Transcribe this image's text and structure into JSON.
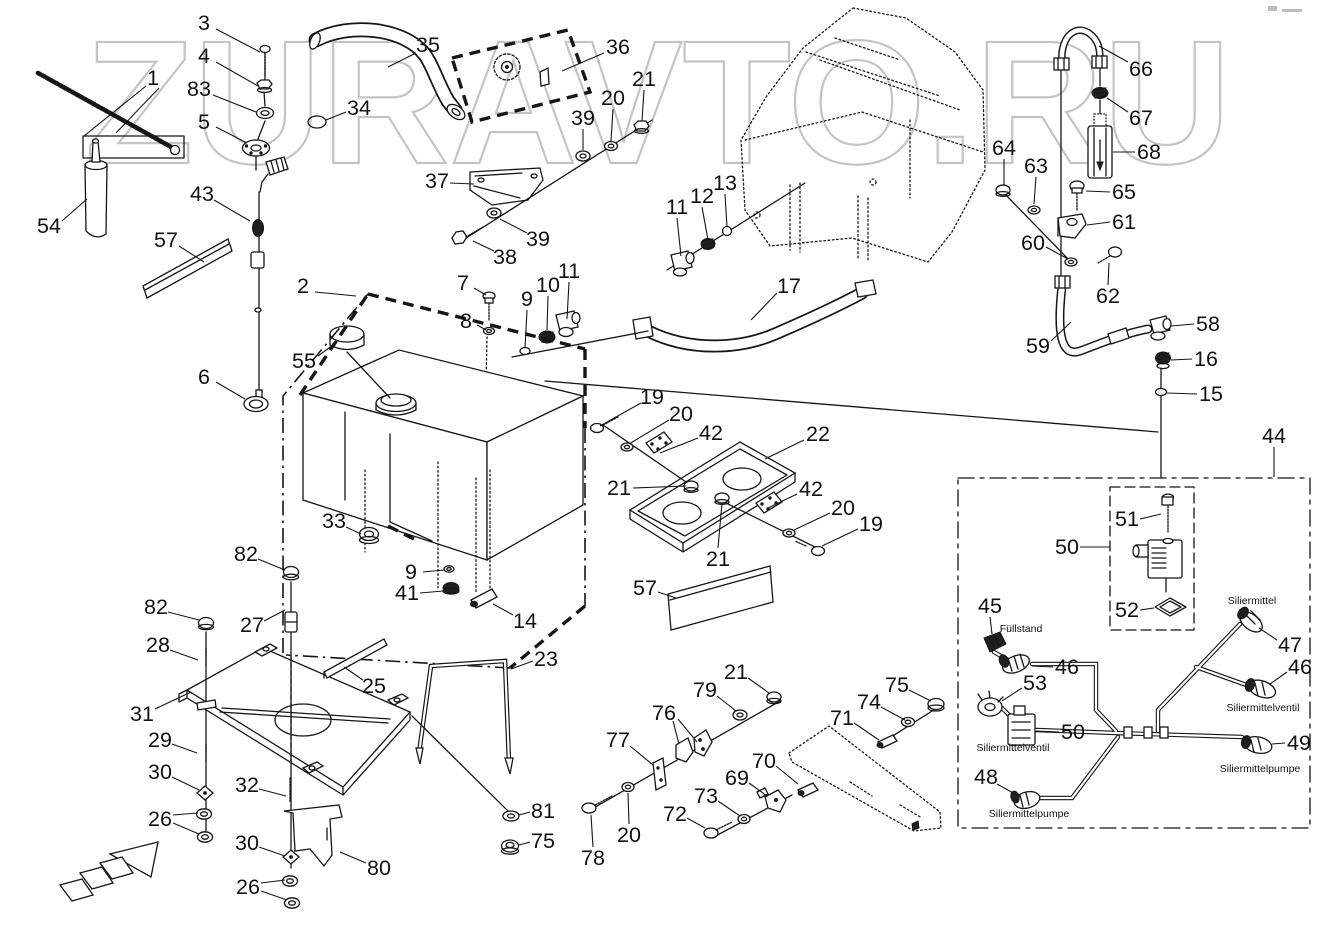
{
  "watermark": {
    "text": "ZURAVTO.RU",
    "color": "#c4c4c4"
  },
  "diagram": {
    "type": "exploded-parts-diagram",
    "language": "de",
    "line_color": "#161616",
    "background": "#ffffff"
  },
  "annotations": [
    {
      "text": "Füllstand",
      "x": 1021,
      "y": 632
    },
    {
      "text": "Siliermittel",
      "x": 1252,
      "y": 604
    },
    {
      "text": "Siliermittelventil",
      "x": 1013,
      "y": 751
    },
    {
      "text": "Siliermittelventil",
      "x": 1263,
      "y": 711
    },
    {
      "text": "Siliermittelpumpe",
      "x": 1029,
      "y": 817
    },
    {
      "text": "Siliermittelpumpe",
      "x": 1260,
      "y": 772
    }
  ],
  "callouts": [
    {
      "n": "3",
      "x": 204,
      "y": 23,
      "l": [
        [
          216,
          29,
          260,
          52
        ]
      ]
    },
    {
      "n": "4",
      "x": 204,
      "y": 56,
      "l": [
        [
          216,
          62,
          258,
          86
        ]
      ]
    },
    {
      "n": "83",
      "x": 199,
      "y": 89,
      "l": [
        [
          213,
          95,
          256,
          112
        ]
      ]
    },
    {
      "n": "5",
      "x": 204,
      "y": 122,
      "l": [
        [
          216,
          127,
          247,
          143
        ]
      ]
    },
    {
      "n": "1",
      "x": 153,
      "y": 78,
      "l": [
        [
          146,
          86,
          84,
          136
        ],
        [
          159,
          88,
          116,
          133
        ]
      ]
    },
    {
      "n": "54",
      "x": 49,
      "y": 226,
      "l": [
        [
          62,
          221,
          87,
          199
        ]
      ]
    },
    {
      "n": "57",
      "x": 166,
      "y": 240,
      "l": [
        [
          179,
          246,
          204,
          262
        ]
      ]
    },
    {
      "n": "43",
      "x": 202,
      "y": 194,
      "l": [
        [
          214,
          200,
          250,
          221
        ]
      ]
    },
    {
      "n": "6",
      "x": 204,
      "y": 377,
      "l": [
        [
          216,
          382,
          245,
          399
        ]
      ]
    },
    {
      "n": "35",
      "x": 428,
      "y": 45,
      "l": [
        [
          416,
          53,
          388,
          67
        ]
      ]
    },
    {
      "n": "34",
      "x": 359,
      "y": 108,
      "l": [
        [
          346,
          112,
          326,
          120
        ]
      ]
    },
    {
      "n": "36",
      "x": 618,
      "y": 47,
      "l": [
        [
          604,
          53,
          562,
          71
        ]
      ]
    },
    {
      "n": "37",
      "x": 437,
      "y": 181,
      "l": [
        [
          450,
          183,
          474,
          184
        ]
      ]
    },
    {
      "n": "38",
      "x": 505,
      "y": 257,
      "l": [
        [
          494,
          251,
          473,
          241
        ]
      ]
    },
    {
      "n": "39",
      "x": 538,
      "y": 239,
      "l": [
        [
          527,
          233,
          500,
          219
        ]
      ]
    },
    {
      "n": "39",
      "x": 583,
      "y": 118,
      "l": [
        [
          583,
          129,
          583,
          150
        ]
      ]
    },
    {
      "n": "20",
      "x": 613,
      "y": 98,
      "l": [
        [
          613,
          109,
          611,
          141
        ]
      ]
    },
    {
      "n": "21",
      "x": 644,
      "y": 79,
      "l": [
        [
          644,
          90,
          642,
          121
        ]
      ]
    },
    {
      "n": "11",
      "x": 677,
      "y": 207,
      "l": [
        [
          677,
          218,
          681,
          256
        ]
      ]
    },
    {
      "n": "12",
      "x": 702,
      "y": 196,
      "l": [
        [
          702,
          207,
          708,
          240
        ]
      ]
    },
    {
      "n": "13",
      "x": 725,
      "y": 183,
      "l": [
        [
          725,
          194,
          727,
          227
        ]
      ]
    },
    {
      "n": "17",
      "x": 789,
      "y": 286,
      "l": [
        [
          777,
          293,
          751,
          320
        ]
      ]
    },
    {
      "n": "2",
      "x": 303,
      "y": 286,
      "l": [
        [
          315,
          292,
          356,
          296
        ]
      ]
    },
    {
      "n": "55",
      "x": 304,
      "y": 361,
      "l": [
        [
          318,
          356,
          337,
          342
        ]
      ]
    },
    {
      "n": "7",
      "x": 463,
      "y": 283,
      "l": [
        [
          474,
          288,
          486,
          295
        ]
      ]
    },
    {
      "n": "8",
      "x": 466,
      "y": 321,
      "l": [
        [
          477,
          325,
          486,
          330
        ]
      ]
    },
    {
      "n": "9",
      "x": 527,
      "y": 299,
      "l": [
        [
          527,
          310,
          525,
          348
        ]
      ]
    },
    {
      "n": "10",
      "x": 548,
      "y": 285,
      "l": [
        [
          548,
          296,
          547,
          330
        ]
      ]
    },
    {
      "n": "11",
      "x": 569,
      "y": 271,
      "l": [
        [
          569,
          282,
          567,
          319
        ]
      ]
    },
    {
      "n": "33",
      "x": 334,
      "y": 521,
      "l": [
        [
          346,
          527,
          361,
          534
        ]
      ]
    },
    {
      "n": "9",
      "x": 411,
      "y": 572,
      "l": [
        [
          423,
          572,
          444,
          570
        ]
      ]
    },
    {
      "n": "41",
      "x": 407,
      "y": 593,
      "l": [
        [
          420,
          593,
          443,
          591
        ]
      ]
    },
    {
      "n": "14",
      "x": 525,
      "y": 621,
      "l": [
        [
          513,
          615,
          493,
          604
        ]
      ]
    },
    {
      "n": "23",
      "x": 546,
      "y": 659,
      "l": [
        [
          533,
          661,
          511,
          669
        ]
      ]
    },
    {
      "n": "25",
      "x": 374,
      "y": 686,
      "l": [
        [
          363,
          680,
          344,
          667
        ]
      ]
    },
    {
      "n": "19",
      "x": 652,
      "y": 397,
      "l": [
        [
          641,
          403,
          600,
          426
        ]
      ]
    },
    {
      "n": "20",
      "x": 681,
      "y": 414,
      "l": [
        [
          669,
          420,
          629,
          444
        ]
      ]
    },
    {
      "n": "42",
      "x": 711,
      "y": 433,
      "l": [
        [
          698,
          438,
          660,
          453
        ]
      ]
    },
    {
      "n": "22",
      "x": 818,
      "y": 434,
      "l": [
        [
          804,
          440,
          765,
          459
        ]
      ]
    },
    {
      "n": "21",
      "x": 619,
      "y": 488,
      "l": [
        [
          633,
          488,
          686,
          486
        ]
      ]
    },
    {
      "n": "21",
      "x": 718,
      "y": 559,
      "l": [
        [
          718,
          548,
          722,
          503
        ]
      ]
    },
    {
      "n": "42",
      "x": 811,
      "y": 489,
      "l": [
        [
          797,
          494,
          768,
          508
        ]
      ]
    },
    {
      "n": "20",
      "x": 843,
      "y": 508,
      "l": [
        [
          830,
          513,
          794,
          530
        ]
      ]
    },
    {
      "n": "19",
      "x": 871,
      "y": 524,
      "l": [
        [
          858,
          529,
          822,
          546
        ]
      ]
    },
    {
      "n": "57",
      "x": 645,
      "y": 588,
      "l": [
        [
          658,
          592,
          676,
          598
        ]
      ]
    },
    {
      "n": "66",
      "x": 1141,
      "y": 69,
      "l": [
        [
          1128,
          62,
          1099,
          46
        ]
      ]
    },
    {
      "n": "67",
      "x": 1141,
      "y": 118,
      "l": [
        [
          1128,
          112,
          1107,
          98
        ]
      ]
    },
    {
      "n": "68",
      "x": 1149,
      "y": 152,
      "l": [
        [
          1135,
          152,
          1113,
          152
        ]
      ]
    },
    {
      "n": "65",
      "x": 1124,
      "y": 192,
      "l": [
        [
          1110,
          192,
          1086,
          191
        ]
      ]
    },
    {
      "n": "64",
      "x": 1004,
      "y": 148,
      "l": [
        [
          1004,
          159,
          1004,
          185
        ]
      ]
    },
    {
      "n": "63",
      "x": 1036,
      "y": 166,
      "l": [
        [
          1036,
          177,
          1034,
          204
        ]
      ]
    },
    {
      "n": "61",
      "x": 1124,
      "y": 222,
      "l": [
        [
          1110,
          222,
          1087,
          225
        ]
      ]
    },
    {
      "n": "60",
      "x": 1033,
      "y": 243,
      "l": [
        [
          1046,
          247,
          1068,
          259
        ]
      ]
    },
    {
      "n": "62",
      "x": 1108,
      "y": 296,
      "l": [
        [
          1108,
          285,
          1109,
          263
        ]
      ]
    },
    {
      "n": "59",
      "x": 1038,
      "y": 346,
      "l": [
        [
          1051,
          341,
          1071,
          322
        ]
      ]
    },
    {
      "n": "58",
      "x": 1208,
      "y": 324,
      "l": [
        [
          1194,
          324,
          1171,
          326
        ]
      ]
    },
    {
      "n": "16",
      "x": 1206,
      "y": 359,
      "l": [
        [
          1192,
          359,
          1171,
          360
        ]
      ]
    },
    {
      "n": "15",
      "x": 1211,
      "y": 394,
      "l": [
        [
          1197,
          394,
          1167,
          393
        ]
      ]
    },
    {
      "n": "44",
      "x": 1274,
      "y": 436,
      "l": [
        [
          1274,
          447,
          1274,
          477
        ]
      ]
    },
    {
      "n": "51",
      "x": 1127,
      "y": 519,
      "l": [
        [
          1140,
          519,
          1161,
          514
        ]
      ]
    },
    {
      "n": "50",
      "x": 1067,
      "y": 547,
      "l": [
        [
          1080,
          547,
          1110,
          547
        ]
      ]
    },
    {
      "n": "52",
      "x": 1127,
      "y": 610,
      "l": [
        [
          1140,
          610,
          1154,
          608
        ]
      ]
    },
    {
      "n": "45",
      "x": 990,
      "y": 606,
      "l": [
        [
          990,
          617,
          992,
          634
        ]
      ]
    },
    {
      "n": "46",
      "x": 1067,
      "y": 667,
      "l": [
        [
          1053,
          667,
          1032,
          666
        ]
      ]
    },
    {
      "n": "53",
      "x": 1035,
      "y": 683,
      "l": [
        [
          1022,
          688,
          1002,
          701
        ]
      ]
    },
    {
      "n": "50",
      "x": 1073,
      "y": 732,
      "l": [
        [
          1059,
          732,
          1036,
          731
        ]
      ]
    },
    {
      "n": "48",
      "x": 986,
      "y": 777,
      "l": [
        [
          997,
          784,
          1015,
          794
        ]
      ]
    },
    {
      "n": "47",
      "x": 1290,
      "y": 645,
      "l": [
        [
          1277,
          640,
          1259,
          628
        ]
      ]
    },
    {
      "n": "46",
      "x": 1300,
      "y": 667,
      "l": [
        [
          1287,
          672,
          1270,
          684
        ]
      ]
    },
    {
      "n": "49",
      "x": 1299,
      "y": 743,
      "l": [
        [
          1285,
          743,
          1272,
          744
        ]
      ]
    },
    {
      "n": "21",
      "x": 736,
      "y": 672,
      "l": [
        [
          748,
          678,
          769,
          693
        ]
      ]
    },
    {
      "n": "79",
      "x": 705,
      "y": 690,
      "l": [
        [
          717,
          696,
          736,
          711
        ]
      ]
    },
    {
      "n": "76",
      "x": 664,
      "y": 713,
      "l": [
        [
          673,
          721,
          679,
          744
        ],
        [
          678,
          719,
          697,
          742
        ]
      ]
    },
    {
      "n": "77",
      "x": 618,
      "y": 740,
      "l": [
        [
          630,
          746,
          653,
          765
        ]
      ]
    },
    {
      "n": "78",
      "x": 593,
      "y": 858,
      "l": [
        [
          593,
          847,
          591,
          815
        ]
      ]
    },
    {
      "n": "20",
      "x": 629,
      "y": 835,
      "l": [
        [
          629,
          824,
          628,
          793
        ]
      ]
    },
    {
      "n": "72",
      "x": 675,
      "y": 814,
      "l": [
        [
          687,
          818,
          705,
          828
        ]
      ]
    },
    {
      "n": "73",
      "x": 706,
      "y": 796,
      "l": [
        [
          718,
          801,
          740,
          816
        ]
      ]
    },
    {
      "n": "69",
      "x": 737,
      "y": 778,
      "l": [
        [
          749,
          783,
          767,
          796
        ]
      ]
    },
    {
      "n": "70",
      "x": 764,
      "y": 761,
      "l": [
        [
          776,
          766,
          798,
          784
        ]
      ]
    },
    {
      "n": "71",
      "x": 842,
      "y": 718,
      "l": [
        [
          854,
          723,
          879,
          740
        ]
      ]
    },
    {
      "n": "74",
      "x": 869,
      "y": 702,
      "l": [
        [
          881,
          707,
          905,
          720
        ]
      ]
    },
    {
      "n": "75",
      "x": 897,
      "y": 685,
      "l": [
        [
          909,
          690,
          931,
          701
        ]
      ]
    },
    {
      "n": "82",
      "x": 246,
      "y": 554,
      "l": [
        [
          258,
          559,
          285,
          570
        ]
      ]
    },
    {
      "n": "82",
      "x": 156,
      "y": 607,
      "l": [
        [
          168,
          612,
          199,
          620
        ]
      ]
    },
    {
      "n": "27",
      "x": 252,
      "y": 625,
      "l": [
        [
          264,
          621,
          285,
          610
        ]
      ]
    },
    {
      "n": "28",
      "x": 158,
      "y": 645,
      "l": [
        [
          170,
          650,
          198,
          660
        ]
      ]
    },
    {
      "n": "31",
      "x": 142,
      "y": 714,
      "l": [
        [
          155,
          709,
          191,
          692
        ]
      ]
    },
    {
      "n": "29",
      "x": 160,
      "y": 740,
      "l": [
        [
          172,
          744,
          197,
          753
        ]
      ]
    },
    {
      "n": "30",
      "x": 160,
      "y": 772,
      "l": [
        [
          172,
          777,
          199,
          790
        ]
      ]
    },
    {
      "n": "26",
      "x": 160,
      "y": 819,
      "l": [
        [
          173,
          815,
          198,
          813
        ],
        [
          173,
          823,
          199,
          834
        ]
      ]
    },
    {
      "n": "32",
      "x": 247,
      "y": 785,
      "l": [
        [
          259,
          789,
          286,
          796
        ]
      ]
    },
    {
      "n": "30",
      "x": 247,
      "y": 843,
      "l": [
        [
          259,
          847,
          285,
          856
        ]
      ]
    },
    {
      "n": "26",
      "x": 248,
      "y": 887,
      "l": [
        [
          261,
          883,
          285,
          880
        ],
        [
          261,
          891,
          287,
          900
        ]
      ]
    },
    {
      "n": "80",
      "x": 379,
      "y": 868,
      "l": [
        [
          366,
          863,
          340,
          852
        ]
      ]
    },
    {
      "n": "81",
      "x": 543,
      "y": 811,
      "l": [
        [
          530,
          812,
          519,
          815
        ]
      ]
    },
    {
      "n": "75",
      "x": 543,
      "y": 841,
      "l": [
        [
          530,
          842,
          519,
          845
        ]
      ]
    }
  ]
}
